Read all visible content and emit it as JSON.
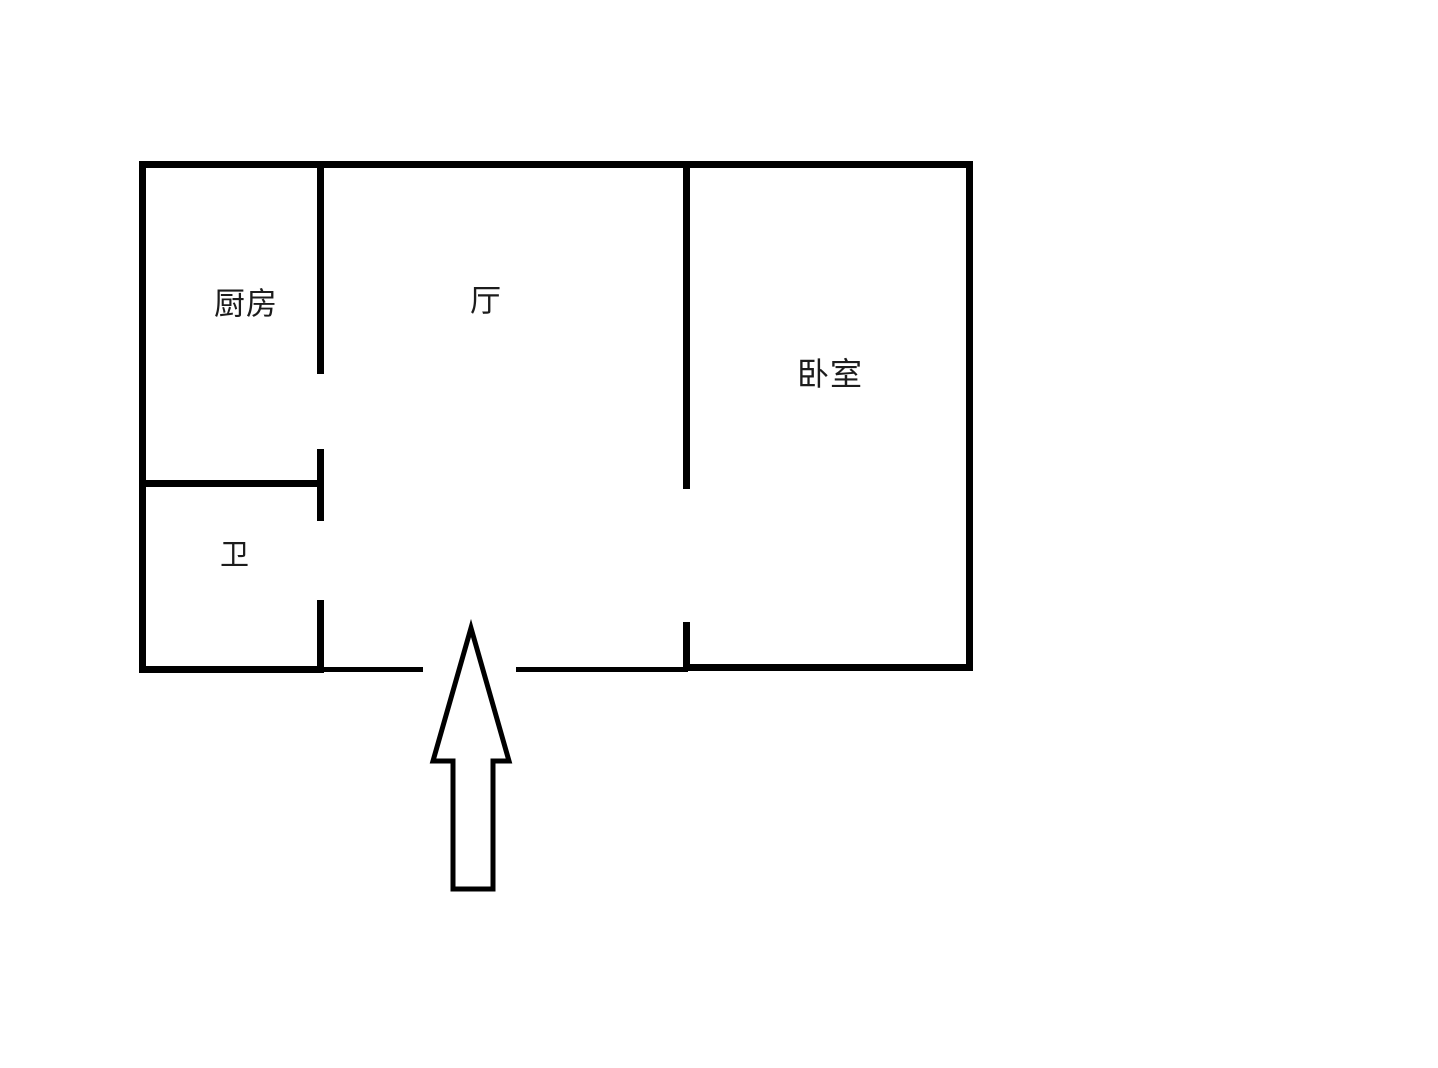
{
  "floor_plan": {
    "colors": {
      "wall": "#000000",
      "background": "#ffffff",
      "text": "#1c1c1c"
    },
    "rooms": {
      "kitchen": {
        "label": "厨房"
      },
      "hall": {
        "label": "厅"
      },
      "bedroom": {
        "label": "卧室"
      },
      "bathroom": {
        "label": "卫"
      }
    },
    "entrance": {
      "icon": "up-arrow-icon"
    }
  }
}
